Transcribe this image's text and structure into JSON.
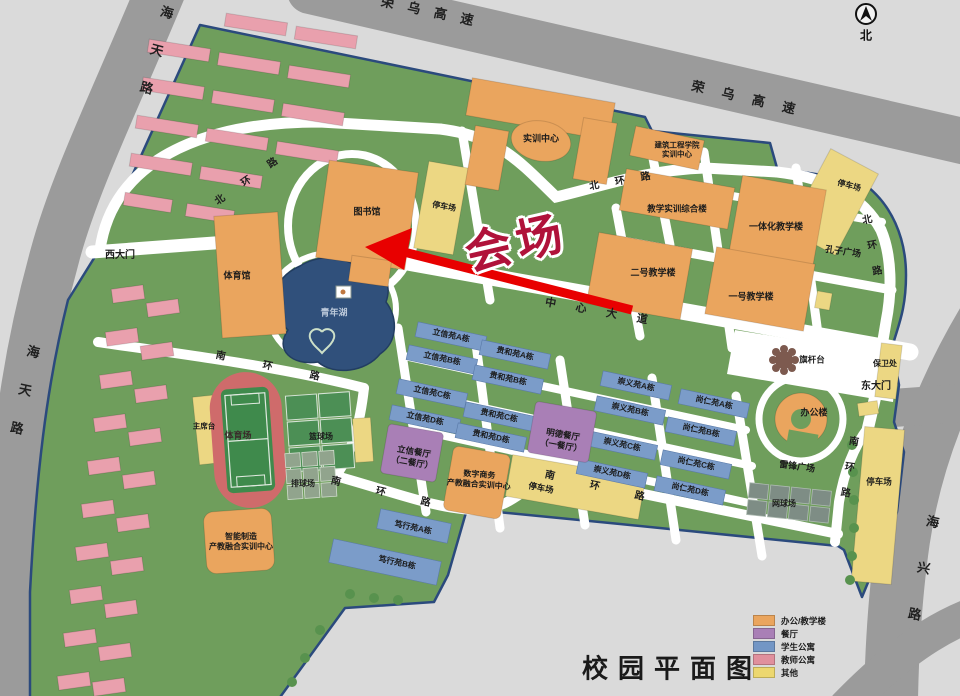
{
  "title": "校园平面图",
  "compass_north": "北",
  "venue_label": "会场",
  "roads": {
    "rongwu_nw": "荣乌高速",
    "rongwu_ne": "荣乌高速",
    "haitian_top": "海天路",
    "haitian_left": "海天路",
    "haixing": "海兴路",
    "north_ring_w": "北环路",
    "north_ring_n": "北环路",
    "north_ring_e": "北环路",
    "central_avenue": "中心大道",
    "south_ring_w": "南环路",
    "south_ring_s1": "南环路",
    "south_ring_s2": "南环路",
    "south_ring_e": "南环路"
  },
  "gates": {
    "west": "西大门",
    "east": "东大门"
  },
  "buildings": {
    "training_center": "实训中心",
    "construction_l1": "建筑工程学院",
    "construction_l2": "实训中心",
    "library": "图书馆",
    "gymnasium": "体育馆",
    "teaching_training_complex": "教学实训综合楼",
    "integrated_teaching_bldg": "一体化教学楼",
    "no2_teaching_bldg": "二号教学楼",
    "no1_teaching_bldg": "一号教学楼",
    "office_bldg": "办公楼",
    "security_office": "保卫处",
    "digital_l1": "数字商务",
    "digital_l2": "产教融合实训中心",
    "smart_l1": "智能制造",
    "smart_l2": "产教融合实训中心"
  },
  "dining": {
    "mingde_l1": "明德餐厅",
    "mingde_l2": "（一餐厅）",
    "lixin_l1": "立信餐厅",
    "lixin_l2": "（二餐厅）"
  },
  "dorms": {
    "lixin_a": "立信苑A栋",
    "lixin_b": "立信苑B栋",
    "lixin_c": "立信苑C栋",
    "lixin_d": "立信苑D栋",
    "guihe_a": "贵和苑A栋",
    "guihe_b": "贵和苑B栋",
    "guihe_c": "贵和苑C栋",
    "guihe_d": "贵和苑D栋",
    "chongyi_a": "崇义苑A栋",
    "chongyi_b": "崇义苑B栋",
    "chongyi_c": "崇义苑C栋",
    "chongyi_d": "崇义苑D栋",
    "shangren_a": "尚仁苑A栋",
    "shangren_b": "尚仁苑B栋",
    "shangren_c": "尚仁苑C栋",
    "shangren_d": "尚仁苑D栋",
    "duxing_a": "笃行苑A栋",
    "duxing_b": "笃行苑B栋"
  },
  "landmarks": {
    "youth_lake": "青年湖",
    "flag_platform": "旗杆台",
    "leifeng_square": "雷锋广场",
    "confucius_square": "孔子广场",
    "rostrum": "主席台"
  },
  "sports": {
    "stadium": "体育场",
    "basketball": "篮球场",
    "volleyball": "排球场",
    "tennis": "网球场"
  },
  "parking": {
    "nw": "停车场",
    "ne": "停车场",
    "south": "停车场",
    "southeast": "停车场"
  },
  "legend": {
    "items": [
      {
        "label": "办公/教学楼",
        "color": "#eaa55e"
      },
      {
        "label": "餐厅",
        "color": "#a97fb6"
      },
      {
        "label": "学生公寓",
        "color": "#7396c5"
      },
      {
        "label": "教师公寓",
        "color": "#e0909d"
      },
      {
        "label": "其他",
        "color": "#ecd76f"
      }
    ]
  },
  "colors": {
    "campus_green": "#6f9e5c",
    "outside_gray": "#dadada",
    "highway_gray": "#9b9b9b",
    "boundary_navy": "#2b4a7d",
    "office_teaching": "#eaa55e",
    "dining": "#a97fb6",
    "student_dorm": "#7b9cc9",
    "teacher_apartment": "#e9a0ad",
    "other": "#ecd783",
    "lake_blue": "#30507b",
    "arrow_red": "#e80000",
    "venue_text_red": "#b0123a"
  }
}
